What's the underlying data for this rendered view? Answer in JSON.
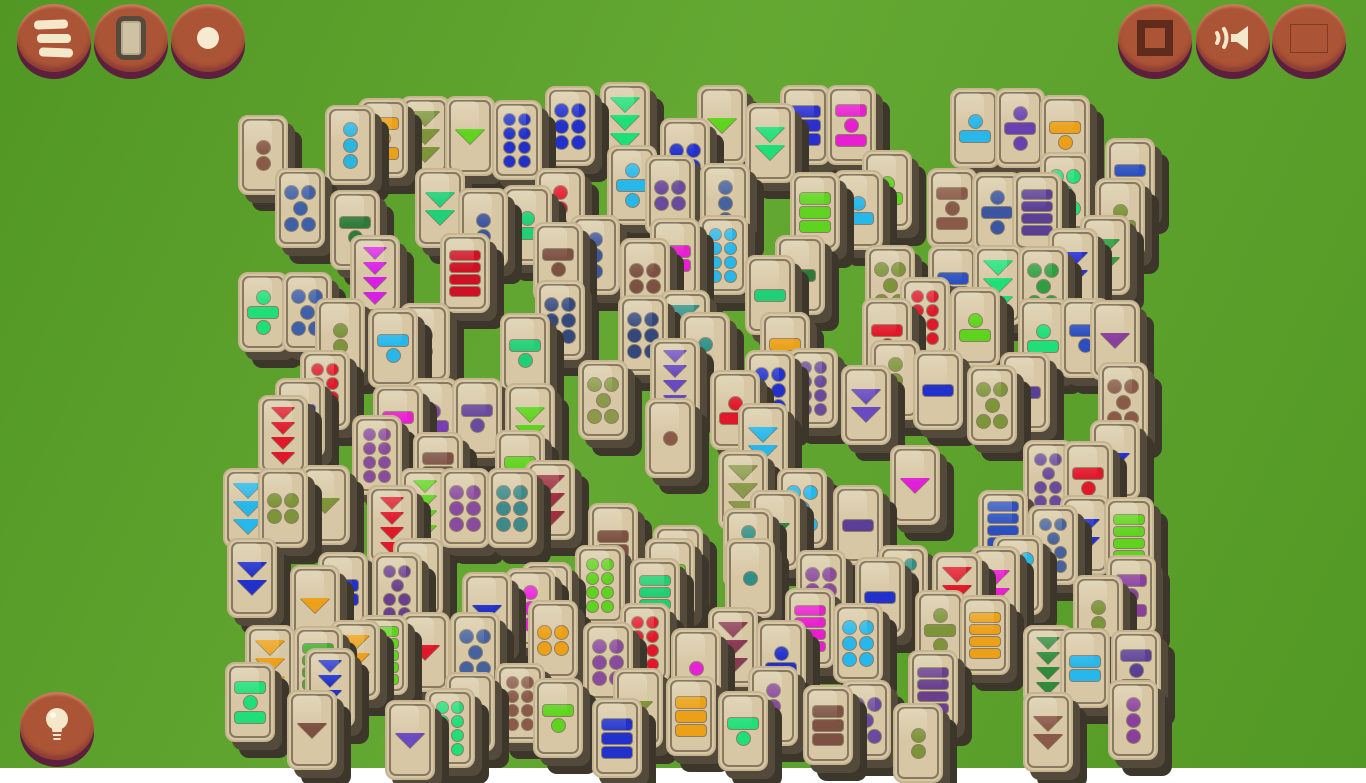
{
  "app_title": "Mahjong tile matching game",
  "background": {
    "plank_color": "#58a228",
    "plank_line": "#387512",
    "plank_height": 46
  },
  "tile_style": {
    "face": "#d7c7a5",
    "rim": "#c6b591",
    "outline": "#46402e",
    "shadow_near": "#544a3b",
    "shadow_far": "#3d362b",
    "width": 50,
    "height": 80
  },
  "buttons": [
    {
      "name": "menu-button",
      "icon": "hamburger-icon",
      "x": 17,
      "y": 4
    },
    {
      "name": "tiles-button",
      "icon": "tile-icon",
      "x": 94,
      "y": 4
    },
    {
      "name": "dot-button",
      "icon": "dot-icon",
      "x": 171,
      "y": 4
    },
    {
      "name": "fullscreen-button",
      "icon": "square-icon",
      "x": 1118,
      "y": 4
    },
    {
      "name": "sound-button",
      "icon": "speaker-icon",
      "x": 1196,
      "y": 4
    },
    {
      "name": "language-button",
      "icon": "flag-russia-icon",
      "x": 1272,
      "y": 4
    },
    {
      "name": "hint-button",
      "icon": "lightbulb-icon",
      "x": 20,
      "y": 692
    }
  ],
  "flag_colors": [
    "#ece9e0",
    "#2f4faa",
    "#cc2128"
  ],
  "icon_color": "#f5e7c9",
  "board": {
    "legend": "tiles: [x, y, pattern, color] — patterns: d=dots (d5=2-1-2, d7=2-1-2-2, d2x3=2 cols 3 rows), b=bars, t=down triangles, db/bd/dbd/bdb = dot-bar mixes",
    "tiles": [
      [
        238,
        115,
        "d2",
        "#8a5948"
      ],
      [
        325,
        105,
        "d3",
        "#2ab4e0"
      ],
      [
        358,
        98,
        "bdb",
        "#eca018"
      ],
      [
        400,
        96,
        "t3",
        "#7d9439"
      ],
      [
        445,
        96,
        "t1",
        "#5fd41f"
      ],
      [
        492,
        100,
        "d2x4",
        "#2231cc"
      ],
      [
        545,
        86,
        "d2x3",
        "#2231cc"
      ],
      [
        600,
        82,
        "t3",
        "#1fdf78"
      ],
      [
        697,
        85,
        "t1",
        "#5fd41f"
      ],
      [
        745,
        103,
        "t2",
        "#1fdf78"
      ],
      [
        780,
        85,
        "b3",
        "#2a2fd0"
      ],
      [
        826,
        85,
        "bdb",
        "#e81fd0"
      ],
      [
        950,
        88,
        "db",
        "#27b7ea"
      ],
      [
        995,
        88,
        "dbd",
        "#6a3fb0"
      ],
      [
        1040,
        95,
        "bd",
        "#eca018"
      ],
      [
        1105,
        138,
        "bd",
        "#2b4fc0"
      ],
      [
        862,
        150,
        "db",
        "#5fd41f"
      ],
      [
        660,
        118,
        "d2x2",
        "#2231cc"
      ],
      [
        645,
        155,
        "d2x2",
        "#6a4a9e"
      ],
      [
        607,
        145,
        "dbd",
        "#27b7ea"
      ],
      [
        275,
        168,
        "d5",
        "#3f5fa8"
      ],
      [
        415,
        168,
        "t2",
        "#1fd077"
      ],
      [
        535,
        168,
        "d3",
        "#e0182a"
      ],
      [
        927,
        168,
        "bdb",
        "#8a5948"
      ],
      [
        972,
        172,
        "dbd",
        "#3b55a0"
      ],
      [
        1012,
        172,
        "b4",
        "#5b3f96"
      ],
      [
        1040,
        152,
        "d5",
        "#1fdf78"
      ],
      [
        1095,
        178,
        "db",
        "#7d9439"
      ],
      [
        458,
        188,
        "d2",
        "#3b55a0"
      ],
      [
        502,
        185,
        "db",
        "#1fd077"
      ],
      [
        700,
        163,
        "d3",
        "#46629e"
      ],
      [
        330,
        190,
        "bd",
        "#2e7a38"
      ],
      [
        570,
        215,
        "d3",
        "#3b55a0"
      ],
      [
        650,
        218,
        "b2",
        "#e81fd0"
      ],
      [
        698,
        215,
        "d2x4",
        "#27b7ea"
      ],
      [
        790,
        172,
        "b3",
        "#5fd41f"
      ],
      [
        833,
        170,
        "db",
        "#27b7ea"
      ],
      [
        1080,
        215,
        "t2",
        "#2f9e3f"
      ],
      [
        1048,
        228,
        "t2",
        "#2a2fd0"
      ],
      [
        533,
        222,
        "bd",
        "#7d5142"
      ],
      [
        620,
        238,
        "d2x2",
        "#7d5142"
      ],
      [
        865,
        245,
        "d5",
        "#7d9439"
      ],
      [
        928,
        245,
        "b2",
        "#2b4fc0"
      ],
      [
        973,
        245,
        "t3",
        "#1fdf78"
      ],
      [
        1018,
        246,
        "d5",
        "#2f9e3f"
      ],
      [
        350,
        235,
        "t4",
        "#d81fe8"
      ],
      [
        440,
        233,
        "b4",
        "#d01024"
      ],
      [
        775,
        235,
        "b1",
        "#2e7a38"
      ],
      [
        745,
        255,
        "b1",
        "#1fd077"
      ],
      [
        238,
        272,
        "dbd",
        "#1fdf78"
      ],
      [
        282,
        272,
        "d5",
        "#3f5fa8"
      ],
      [
        315,
        298,
        "d2",
        "#7d9439"
      ],
      [
        368,
        308,
        "bd",
        "#27b7ea"
      ],
      [
        400,
        303,
        "d2",
        "#5fd41f"
      ],
      [
        500,
        313,
        "bd",
        "#1fd077"
      ],
      [
        535,
        280,
        "d2x3",
        "#34487e"
      ],
      [
        618,
        295,
        "d2x3",
        "#34487e"
      ],
      [
        660,
        290,
        "t3",
        "#2e8f86"
      ],
      [
        680,
        312,
        "d2",
        "#2e8f86"
      ],
      [
        760,
        312,
        "bd",
        "#eca018"
      ],
      [
        900,
        277,
        "d2x4",
        "#e0182a"
      ],
      [
        950,
        287,
        "db",
        "#5fd41f"
      ],
      [
        862,
        298,
        "bd",
        "#e0182a"
      ],
      [
        1060,
        298,
        "bd",
        "#2b4fc0"
      ],
      [
        1018,
        298,
        "db",
        "#1fdf78"
      ],
      [
        1090,
        300,
        "t1",
        "#8a3f9e"
      ],
      [
        300,
        350,
        "d2x4",
        "#e0182a"
      ],
      [
        275,
        378,
        "bd",
        "#2231cc"
      ],
      [
        258,
        395,
        "t4",
        "#e0182a"
      ],
      [
        352,
        415,
        "d2x4",
        "#8a4a9e"
      ],
      [
        373,
        385,
        "bd",
        "#e81fd0"
      ],
      [
        408,
        378,
        "db",
        "#7a3fae"
      ],
      [
        452,
        378,
        "bd",
        "#6a4a9e"
      ],
      [
        505,
        383,
        "t2",
        "#5fd41f"
      ],
      [
        413,
        432,
        "b3",
        "#7d5142"
      ],
      [
        495,
        430,
        "bd",
        "#5fd41f"
      ],
      [
        578,
        360,
        "d5",
        "#8a9a4a"
      ],
      [
        650,
        338,
        "t4",
        "#6a4ac0"
      ],
      [
        710,
        370,
        "db",
        "#e0182a"
      ],
      [
        745,
        350,
        "d2x3",
        "#2231cc"
      ],
      [
        788,
        348,
        "d2x4",
        "#6a4a9e"
      ],
      [
        841,
        365,
        "t2",
        "#6a4ac0"
      ],
      [
        870,
        340,
        "d3",
        "#7d9439"
      ],
      [
        913,
        350,
        "b1",
        "#2231cc"
      ],
      [
        967,
        365,
        "d5",
        "#7d9439"
      ],
      [
        1000,
        352,
        "b1",
        "#5b3f96"
      ],
      [
        1098,
        362,
        "d5",
        "#8a5948"
      ],
      [
        645,
        398,
        "d1",
        "#8a5948"
      ],
      [
        738,
        403,
        "t2",
        "#27b7ea"
      ],
      [
        1090,
        420,
        "t1",
        "#2231cc"
      ],
      [
        1023,
        440,
        "d7",
        "#6a4a9e"
      ],
      [
        1063,
        441,
        "bd",
        "#e0182a"
      ],
      [
        890,
        445,
        "t1",
        "#e020d8"
      ],
      [
        223,
        468,
        "t3",
        "#27b7ea"
      ],
      [
        258,
        468,
        "d2x2",
        "#7d9439"
      ],
      [
        300,
        465,
        "t1",
        "#7d9439"
      ],
      [
        367,
        485,
        "t4",
        "#e0182a"
      ],
      [
        400,
        468,
        "t4",
        "#5fd41f"
      ],
      [
        440,
        468,
        "d2x3",
        "#8a4a9e"
      ],
      [
        487,
        468,
        "d2x3",
        "#3d8a8a"
      ],
      [
        525,
        460,
        "t3",
        "#9e3040"
      ],
      [
        718,
        450,
        "t3",
        "#8a9a4a"
      ],
      [
        750,
        490,
        "t1",
        "#2e8540"
      ],
      [
        777,
        468,
        "d5",
        "#27b7ea"
      ],
      [
        833,
        485,
        "b1",
        "#5b3f96"
      ],
      [
        723,
        508,
        "d3",
        "#2e8f86"
      ],
      [
        588,
        503,
        "b2",
        "#7d5142"
      ],
      [
        653,
        525,
        "db",
        "#5fd41f"
      ],
      [
        978,
        490,
        "b5",
        "#2b4fc0"
      ],
      [
        1060,
        495,
        "t2",
        "#2231cc"
      ],
      [
        1104,
        497,
        "b4",
        "#5fd41f"
      ],
      [
        1028,
        505,
        "d7",
        "#46629e"
      ],
      [
        993,
        535,
        "d5",
        "#27b7ea"
      ],
      [
        227,
        538,
        "t2",
        "#2231cc"
      ],
      [
        393,
        538,
        "db",
        "#e81fd0"
      ],
      [
        725,
        538,
        "d1",
        "#2e8f86"
      ],
      [
        645,
        538,
        "bd",
        "#5fd41f"
      ],
      [
        575,
        545,
        "d2x4",
        "#5fd41f"
      ],
      [
        878,
        545,
        "d2x4",
        "#2e8f86"
      ],
      [
        290,
        565,
        "t1",
        "#eca018"
      ],
      [
        318,
        552,
        "b2",
        "#2231cc"
      ],
      [
        372,
        552,
        "d7",
        "#6a3f8e"
      ],
      [
        462,
        572,
        "t1",
        "#2231cc"
      ],
      [
        505,
        568,
        "d3",
        "#e820d8"
      ],
      [
        522,
        562,
        "b3",
        "#2e7a38"
      ],
      [
        932,
        552,
        "t3",
        "#e0182a"
      ],
      [
        970,
        546,
        "t2",
        "#e81fd0"
      ],
      [
        1073,
        575,
        "d2",
        "#7d9439"
      ],
      [
        1106,
        555,
        "bdb",
        "#8a3f9e"
      ],
      [
        796,
        550,
        "d2x3",
        "#8a4a9e"
      ],
      [
        855,
        557,
        "b1",
        "#2231cc"
      ],
      [
        630,
        558,
        "b4",
        "#1fcf70"
      ],
      [
        915,
        590,
        "dbd",
        "#7d9439"
      ],
      [
        960,
        595,
        "b4",
        "#eca018"
      ],
      [
        785,
        588,
        "b4",
        "#e81fd0"
      ],
      [
        528,
        600,
        "d2x2",
        "#eca018"
      ],
      [
        620,
        603,
        "d2x4",
        "#e0182a"
      ],
      [
        833,
        603,
        "d2x3",
        "#27b7ea"
      ],
      [
        708,
        607,
        "t3",
        "#8a3a52"
      ],
      [
        358,
        615,
        "b5",
        "#5fd41f"
      ],
      [
        400,
        612,
        "t1",
        "#e0182a"
      ],
      [
        450,
        612,
        "d5",
        "#46629e"
      ],
      [
        245,
        625,
        "t3",
        "#eca018"
      ],
      [
        293,
        626,
        "b4",
        "#3fae2a"
      ],
      [
        330,
        620,
        "t3",
        "#eca018"
      ],
      [
        583,
        622,
        "d2x3",
        "#8a4a9e"
      ],
      [
        671,
        628,
        "d1",
        "#e820d8"
      ],
      [
        756,
        620,
        "db",
        "#2231cc"
      ],
      [
        1023,
        625,
        "t4",
        "#2f8a3a"
      ],
      [
        1060,
        628,
        "b2",
        "#27b7ea"
      ],
      [
        1111,
        630,
        "bdb",
        "#5b3f96"
      ],
      [
        225,
        662,
        "bdb",
        "#1fdf78"
      ],
      [
        305,
        648,
        "t4",
        "#2231cc"
      ],
      [
        287,
        690,
        "t1",
        "#7d5142"
      ],
      [
        385,
        700,
        "t1",
        "#6a4ac0"
      ],
      [
        425,
        688,
        "d2x4",
        "#1fdf78"
      ],
      [
        445,
        672,
        "d1",
        "#8a5948"
      ],
      [
        495,
        663,
        "d2x4",
        "#8a5948"
      ],
      [
        533,
        678,
        "bd",
        "#5fd41f"
      ],
      [
        592,
        698,
        "b3",
        "#2231cc"
      ],
      [
        613,
        668,
        "t1",
        "#7d9439"
      ],
      [
        666,
        676,
        "b3",
        "#eca018"
      ],
      [
        718,
        691,
        "bd",
        "#1fdf78"
      ],
      [
        748,
        666,
        "d3",
        "#8a4a9e"
      ],
      [
        803,
        685,
        "b3",
        "#7d5142"
      ],
      [
        841,
        680,
        "d5",
        "#6a4a9e"
      ],
      [
        908,
        650,
        "b4",
        "#6a3f8e"
      ],
      [
        893,
        703,
        "d2",
        "#7d9439"
      ],
      [
        1023,
        692,
        "t2",
        "#8a5948"
      ],
      [
        1108,
        680,
        "d3",
        "#8a3f9e"
      ]
    ]
  }
}
